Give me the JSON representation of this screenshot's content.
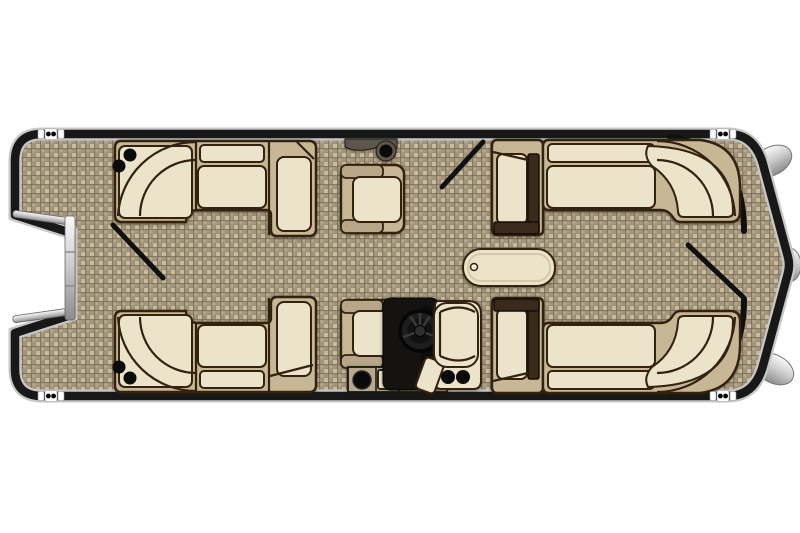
{
  "canvas": {
    "width": 800,
    "height": 533,
    "background": "#ffffff"
  },
  "colors": {
    "hull": "#181818",
    "hullHalo": "#c7c7c7",
    "floorBase": "#a3967c",
    "floorLight": "#c9bc9e",
    "floorMidLight": "#b4a78b",
    "floorDark": "#6e6350",
    "cushionCream": "#ece3cb",
    "cushionTan": "#c8b795",
    "outlineBrown": "#32220f",
    "armDark": "#3a2a1c",
    "helmBlack": "#151311",
    "silverLight": "#fafafa",
    "silverMid": "#cfcfcf",
    "silverDark": "#8c8c8c",
    "podTaupe": "#5d564a",
    "dotBlack": "#0a0a0a",
    "notchWhite": "#ffffff",
    "tableInner": "#d6c9a9"
  },
  "floor_plan": {
    "subject": "pontoon-boat-top-view",
    "orientation": "horizontal",
    "pontoon_nose_cones": 3,
    "dock_cleats": 4,
    "boarding_gate_side": "left",
    "gate_swing_lines": 3,
    "lounges": [
      "bow-port-wraparound-lounge",
      "bow-starboard-wraparound-lounge",
      "stern-port-wraparound-lounge",
      "stern-starboard-wraparound-lounge"
    ],
    "chairs": [
      "port-recliner-chair",
      "starboard-recliner-chair",
      "captains-chair"
    ],
    "helm": {
      "console": true,
      "steering_wheel": true,
      "storage_cabinet": true
    },
    "table": {
      "shape": "oval",
      "pedestal_mount": true
    },
    "cupholders": 6
  }
}
